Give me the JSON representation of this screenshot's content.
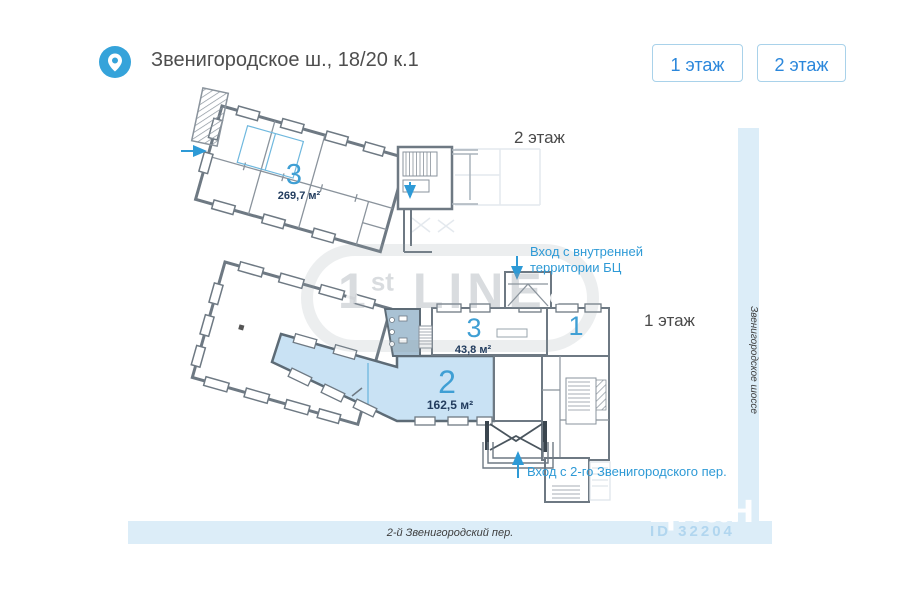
{
  "header": {
    "address": "Звенигородское ш., 18/20 к.1",
    "pin_icon": "location-pin"
  },
  "floor_buttons": {
    "floor1": "1 этаж",
    "floor2": "2 этаж"
  },
  "plan": {
    "floor2": {
      "label": "2 этаж",
      "room3_number": "3",
      "room3_area": "269,7 м²"
    },
    "floor1": {
      "label": "1 этаж",
      "room3_number": "3",
      "room3_area": "43,8 м²",
      "room2_number": "2",
      "room2_area": "162,5 м²",
      "room1_number": "1"
    },
    "entrances": {
      "top_line1": "Вход с внутренней",
      "top_line2": "территории БЦ",
      "bottom": "Вход с 2-го Звенигородского пер."
    }
  },
  "streets": {
    "right": "Звенигородское шоссе",
    "bottom": "2-й Звенигородский пер."
  },
  "watermarks": {
    "first_line_1": "1",
    "first_line_sup": "st",
    "first_line_rest": " LINE",
    "cian": "циан",
    "cian_id": "ID 32204"
  },
  "colors": {
    "accent_blue": "#2b87db",
    "annotation_blue": "#2e9ad6",
    "room_number_blue": "#3f9fd4",
    "room_fill": "#c9e2f4",
    "wc_fill": "#a9c2d4",
    "street_band": "#dcedf8",
    "wall_gray": "#6e7983"
  }
}
